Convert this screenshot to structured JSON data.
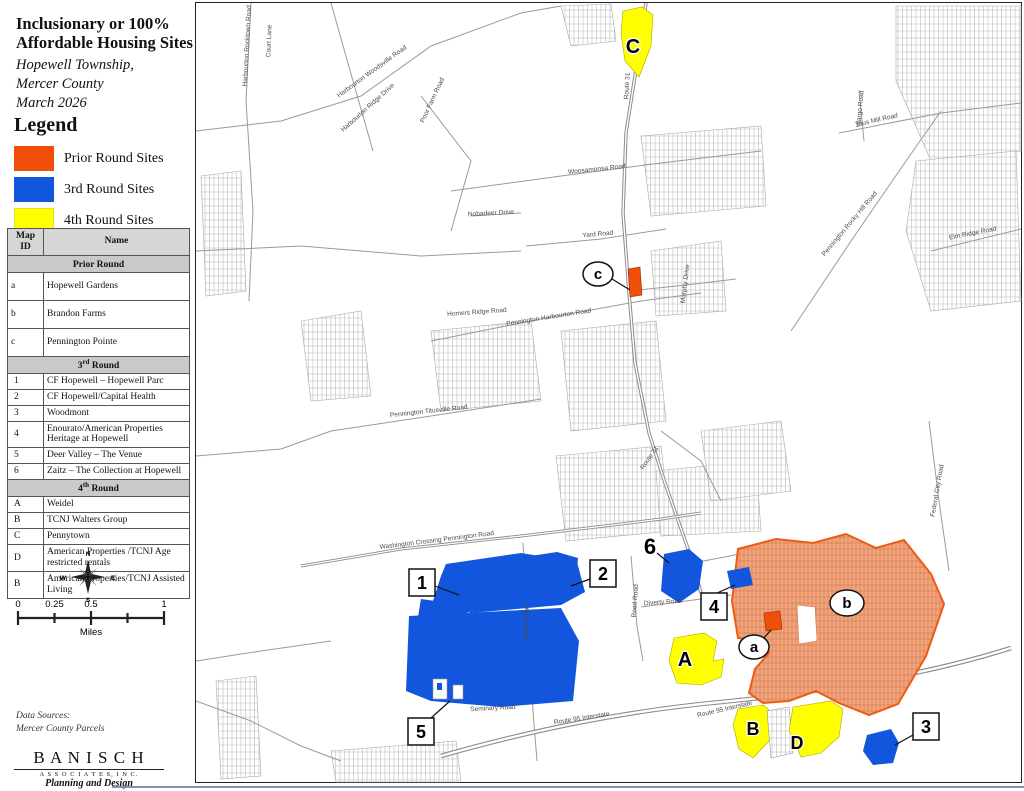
{
  "title": {
    "line1": "Inclusionary or 100%",
    "line2": "Affordable Housing Sites",
    "sub1": "Hopewell Township,",
    "sub2": "Mercer County",
    "sub3": "March 2026"
  },
  "legend": {
    "title": "Legend",
    "items": [
      {
        "label": "Prior Round Sites",
        "color": "#F04F0A"
      },
      {
        "label": "3rd Round Sites",
        "color": "#1156DC"
      },
      {
        "label": "4th Round Sites",
        "color": "#FFFF00"
      }
    ]
  },
  "colors": {
    "prior": "#F04F0A",
    "prior_border": "#EC5B13",
    "third": "#1156DC",
    "fourth": "#FFFF00"
  },
  "table": {
    "col_id": "Map ID",
    "col_name": "Name",
    "sections": [
      {
        "pre": "Prior Round",
        "sup": "",
        "post": "",
        "rows": [
          {
            "id": "a",
            "name": "Hopewell Gardens"
          },
          {
            "id": "b",
            "name": "Brandon Farms"
          },
          {
            "id": "c",
            "name": "Pennington Pointe"
          }
        ]
      },
      {
        "pre": "3",
        "sup": "rd",
        "post": " Round",
        "rows": [
          {
            "id": "1",
            "name": "CF Hopewell – Hopewell Parc"
          },
          {
            "id": "2",
            "name": "CF Hopewell/Capital Health"
          },
          {
            "id": "3",
            "name": "Woodmont"
          },
          {
            "id": "4",
            "name": "Enourato/American Properties Heritage at Hopewell"
          },
          {
            "id": "5",
            "name": "Deer Valley – The Venue"
          },
          {
            "id": "6",
            "name": "Zaitz – The Collection at Hopewell"
          }
        ]
      },
      {
        "pre": "4",
        "sup": "th",
        "post": " Round",
        "rows": [
          {
            "id": "A",
            "name": "Weidel"
          },
          {
            "id": "B",
            "name": "TCNJ Walters Group"
          },
          {
            "id": "C",
            "name": "Pennytown"
          },
          {
            "id": "D",
            "name": "American Properties /TCNJ Age restricted rentals"
          },
          {
            "id": "B",
            "name": "American Properties/TCNJ Assisted Living"
          }
        ]
      }
    ]
  },
  "compass": {
    "n": "N",
    "s": "S",
    "e": "E",
    "w": "W"
  },
  "scalebar": {
    "t0": "0",
    "t1": "0.25",
    "t2": "0.5",
    "t3": "1",
    "units": "Miles"
  },
  "credits": {
    "line1": "Data Sources:",
    "line2": "Mercer County Parcels"
  },
  "logo": {
    "name": "B A N I S C H",
    "sub": "A S S O C I A T E S, I N C.",
    "tag": "Planning and Design"
  },
  "map": {
    "site_labels": {
      "s1": "1",
      "s2": "2",
      "s3": "3",
      "s4": "4",
      "s5": "5",
      "s6": "6",
      "sa": "a",
      "sb": "b",
      "sc": "c",
      "sA": "A",
      "sB": "B",
      "sC": "C",
      "sD": "D"
    },
    "road_labels": [
      "Harbourton Rocktown Road",
      "Court Lane",
      "Harbourton Woodsville Road",
      "Harbourton Ridge Drive",
      "Poor Farm Road",
      "Woosamonsa Road",
      "Nobadeer Drive",
      "Yard Road",
      "Route 31",
      "Route 31",
      "Pennington Harbourton Road",
      "Homers Ridge Road",
      "Pennington Titusville Road",
      "Washington Crossing Pennington Road",
      "Scotch Road",
      "Route 95 Interstate",
      "Route 95 Interstate",
      "Titus Mill Road",
      "Wargo Road",
      "Pennington Rocky Hill Road",
      "Elm Ridge Road",
      "Federal City Road",
      "Reed Road",
      "Diverty Road",
      "Seminary Road",
      "Murphy Drive"
    ]
  }
}
